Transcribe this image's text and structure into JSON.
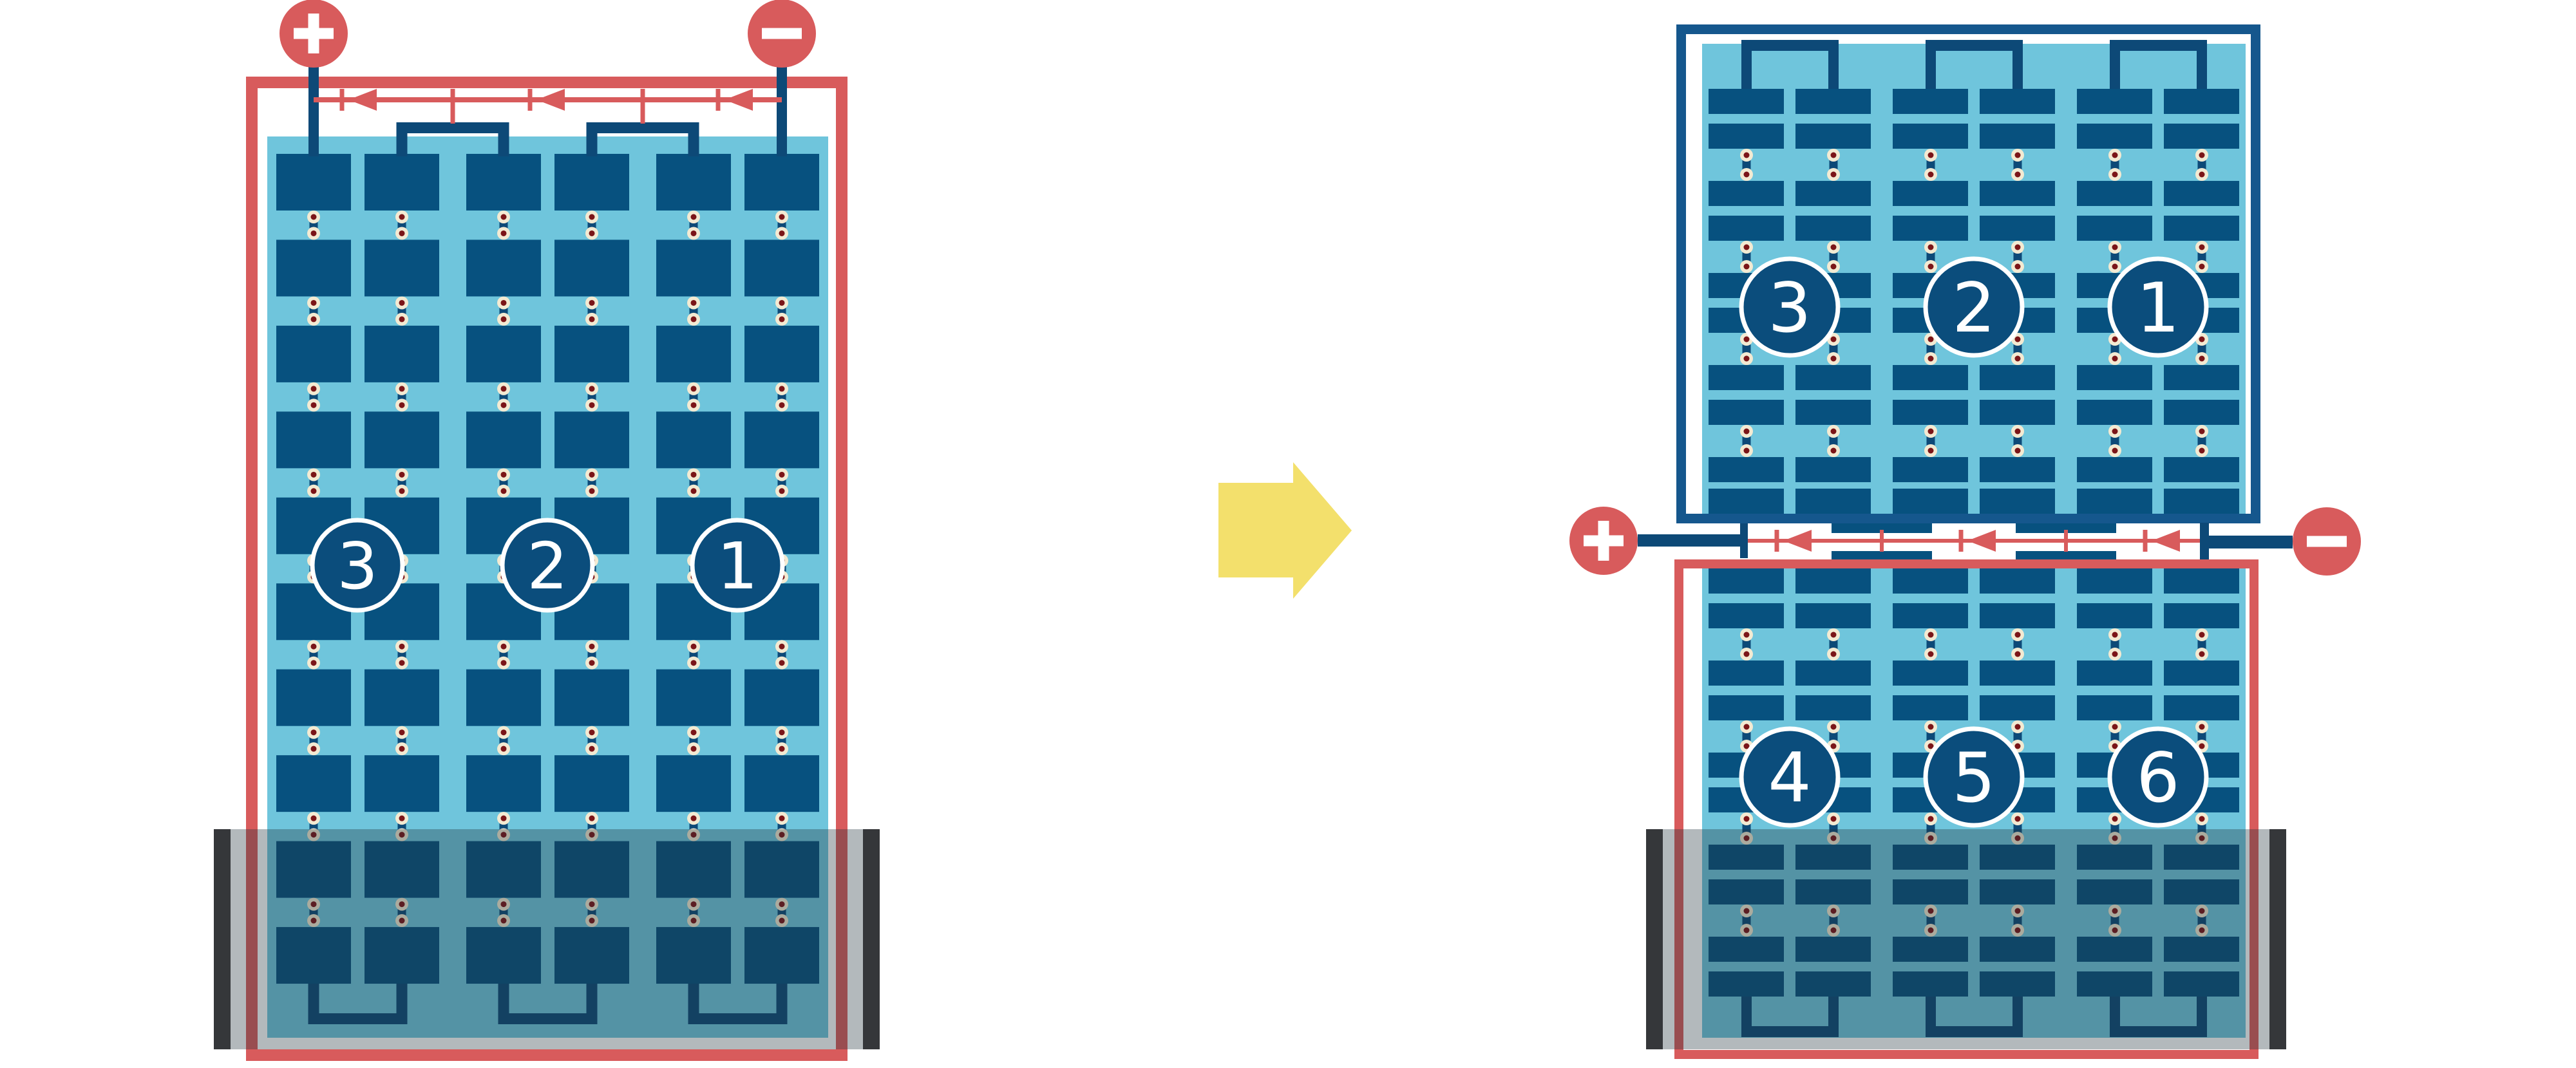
{
  "diagram": {
    "description": "solar module string wiring before and after half-cut redesign with flooded base",
    "left_module": {
      "terminal_plus": "+",
      "terminal_minus": "-",
      "string_labels": [
        "3",
        "2",
        "1"
      ],
      "bypass_diode_count": 3,
      "flooded": true
    },
    "right_top_module": {
      "string_labels": [
        "3",
        "2",
        "1"
      ],
      "flooded": false
    },
    "right_bottom_module": {
      "string_labels": [
        "4",
        "5",
        "6"
      ],
      "flooded": true
    },
    "junction": {
      "terminal_plus": "+",
      "terminal_minus": "-",
      "bypass_diode_count": 3
    },
    "colors": {
      "red": "#D85B5C",
      "light_blue": "#6FC5DC",
      "cell_navy": "#07517F",
      "connector_navy": "#0D4977",
      "frame_blue": "#15578D",
      "badge_fill": "#0B4D7C",
      "pad_ring": "#F3EAD2",
      "pad_dot": "#7B1518",
      "arrow_yellow": "#F3E06C",
      "flood_bar": "#35373A",
      "flood_overlay": "rgba(33,50,58,0.34)",
      "white": "#FFFFFF"
    }
  }
}
